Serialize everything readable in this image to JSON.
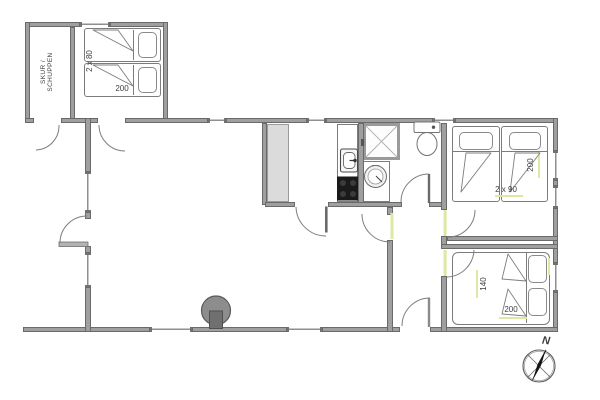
{
  "labels": {
    "shed_line1": "SKUR /",
    "shed_line2": "SCHUPPEN",
    "annex_bed_width": "2 x 80",
    "annex_bed_length": "200",
    "bedroom1_bed_width": "2 x 90",
    "bedroom1_bed_length": "200",
    "bedroom2_bed_width": "140",
    "bedroom2_bed_length": "200",
    "compass_north": "N"
  },
  "colors": {
    "wall": "#9f9f9f",
    "wall-border": "#6a6a6a",
    "outline": "#7c7c7c",
    "cabinet": "#dbdbdb",
    "accent": "#dce9a4",
    "text": "#3f3f3f",
    "background": "#ffffff"
  }
}
